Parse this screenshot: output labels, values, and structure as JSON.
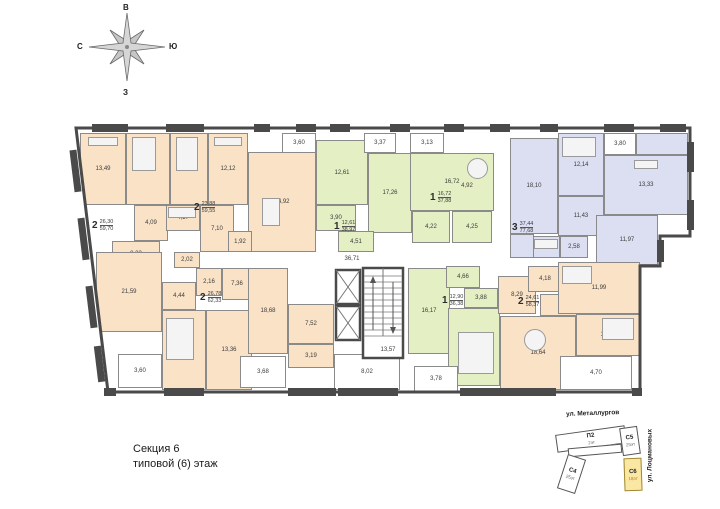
{
  "compass": {
    "top": "В",
    "left": "С",
    "right": "Ю",
    "bottom": "З"
  },
  "caption": {
    "line1": "Секция 6",
    "line2": "типовой (6) этаж"
  },
  "plan": {
    "corridor_area": "36,71",
    "stairs_area": "13,57",
    "rooms": [
      {
        "name": "bedroom",
        "area": "13,49"
      },
      {
        "name": "bedroom",
        "area": "12,81"
      },
      {
        "name": "bedroom",
        "area": "11,76"
      },
      {
        "name": "bedroom",
        "area": "12,12"
      },
      {
        "name": "kitchen-living",
        "area": "14,92"
      },
      {
        "name": "balcony",
        "area": "3,60"
      },
      {
        "name": "bathroom",
        "area": "4,09"
      },
      {
        "name": "bathroom",
        "area": "4,17"
      },
      {
        "name": "hall",
        "area": "7,10"
      },
      {
        "name": "wc",
        "area": "1,92"
      },
      {
        "name": "hall",
        "area": "8,23"
      },
      {
        "name": "storage",
        "area": "2,02"
      },
      {
        "name": "bedroom",
        "area": "12,61"
      },
      {
        "name": "balcony",
        "area": "3,37"
      },
      {
        "name": "kitchen",
        "area": "17,26"
      },
      {
        "name": "hall",
        "area": "3,90"
      },
      {
        "name": "bathroom",
        "area": "4,51"
      },
      {
        "name": "balcony",
        "area": "3,13"
      },
      {
        "name": "kitchen-living",
        "area": "16,72"
      },
      {
        "name": "niche",
        "area": "4,92"
      },
      {
        "name": "hall",
        "area": "4,22"
      },
      {
        "name": "bathroom",
        "area": "4,25"
      },
      {
        "name": "kitchen-living",
        "area": "18,10"
      },
      {
        "name": "bedroom",
        "area": "12,14"
      },
      {
        "name": "balcony",
        "area": "3,80"
      },
      {
        "name": "bedroom",
        "area": "13,33"
      },
      {
        "name": "hall",
        "area": "11,43"
      },
      {
        "name": "bedroom",
        "area": "11,97"
      },
      {
        "name": "wc",
        "area": "2,58"
      },
      {
        "name": "bathroom",
        "area": "3,11"
      },
      {
        "name": "living",
        "area": "21,59"
      },
      {
        "name": "hall",
        "area": "4,44"
      },
      {
        "name": "wc",
        "area": "2,16"
      },
      {
        "name": "bathroom",
        "area": "7,36"
      },
      {
        "name": "bedroom",
        "area": "13,42"
      },
      {
        "name": "bedroom",
        "area": "13,36"
      },
      {
        "name": "balcony",
        "area": "3,60"
      },
      {
        "name": "kitchen-living",
        "area": "18,68"
      },
      {
        "name": "hall",
        "area": "7,52"
      },
      {
        "name": "bathroom",
        "area": "3,19"
      },
      {
        "name": "balcony",
        "area": "3,68"
      },
      {
        "name": "lobby",
        "area": "8,02"
      },
      {
        "name": "kitchen",
        "area": "16,17"
      },
      {
        "name": "hall",
        "area": "4,66"
      },
      {
        "name": "bathroom",
        "area": "3,88"
      },
      {
        "name": "bedroom",
        "area": "12,90"
      },
      {
        "name": "balcony",
        "area": "3,78"
      },
      {
        "name": "kitchen",
        "area": "8,29"
      },
      {
        "name": "bathroom",
        "area": "4,18"
      },
      {
        "name": "living",
        "area": "18,64"
      },
      {
        "name": "bedroom",
        "area": "11,99"
      },
      {
        "name": "bedroom",
        "area": "12,62"
      },
      {
        "name": "balcony",
        "area": "4,70"
      }
    ],
    "apartments": [
      {
        "rooms": "2",
        "living": "26,30",
        "total": "59,70"
      },
      {
        "rooms": "2",
        "living": "23,88",
        "total": "59,55"
      },
      {
        "rooms": "1",
        "living": "12,61",
        "total": "38,97"
      },
      {
        "rooms": "1",
        "living": "16,72",
        "total": "37,88"
      },
      {
        "rooms": "3",
        "living": "37,44",
        "total": "77,68"
      },
      {
        "rooms": "2",
        "living": "26,78",
        "total": "62,33"
      },
      {
        "rooms": "1",
        "living": "12,90",
        "total": "36,38"
      },
      {
        "rooms": "2",
        "living": "24,61",
        "total": "58,37"
      }
    ]
  },
  "minimap": {
    "street_top": "ул. Металлургов",
    "street_right": "ул. Лоцмановых",
    "buildings": [
      {
        "name": "П2",
        "floors": "2эт"
      },
      {
        "name": "С5",
        "floors": "25эт"
      },
      {
        "name": "С4",
        "floors": "25эт"
      },
      {
        "name": "С6",
        "floors": "18эт",
        "highlighted": true
      }
    ]
  },
  "colors": {
    "orange": "#f9e2c6",
    "green": "#e4efc4",
    "blue": "#dcdff2",
    "wall": "#4a4a4a",
    "highlight": "#f9e7a3"
  }
}
